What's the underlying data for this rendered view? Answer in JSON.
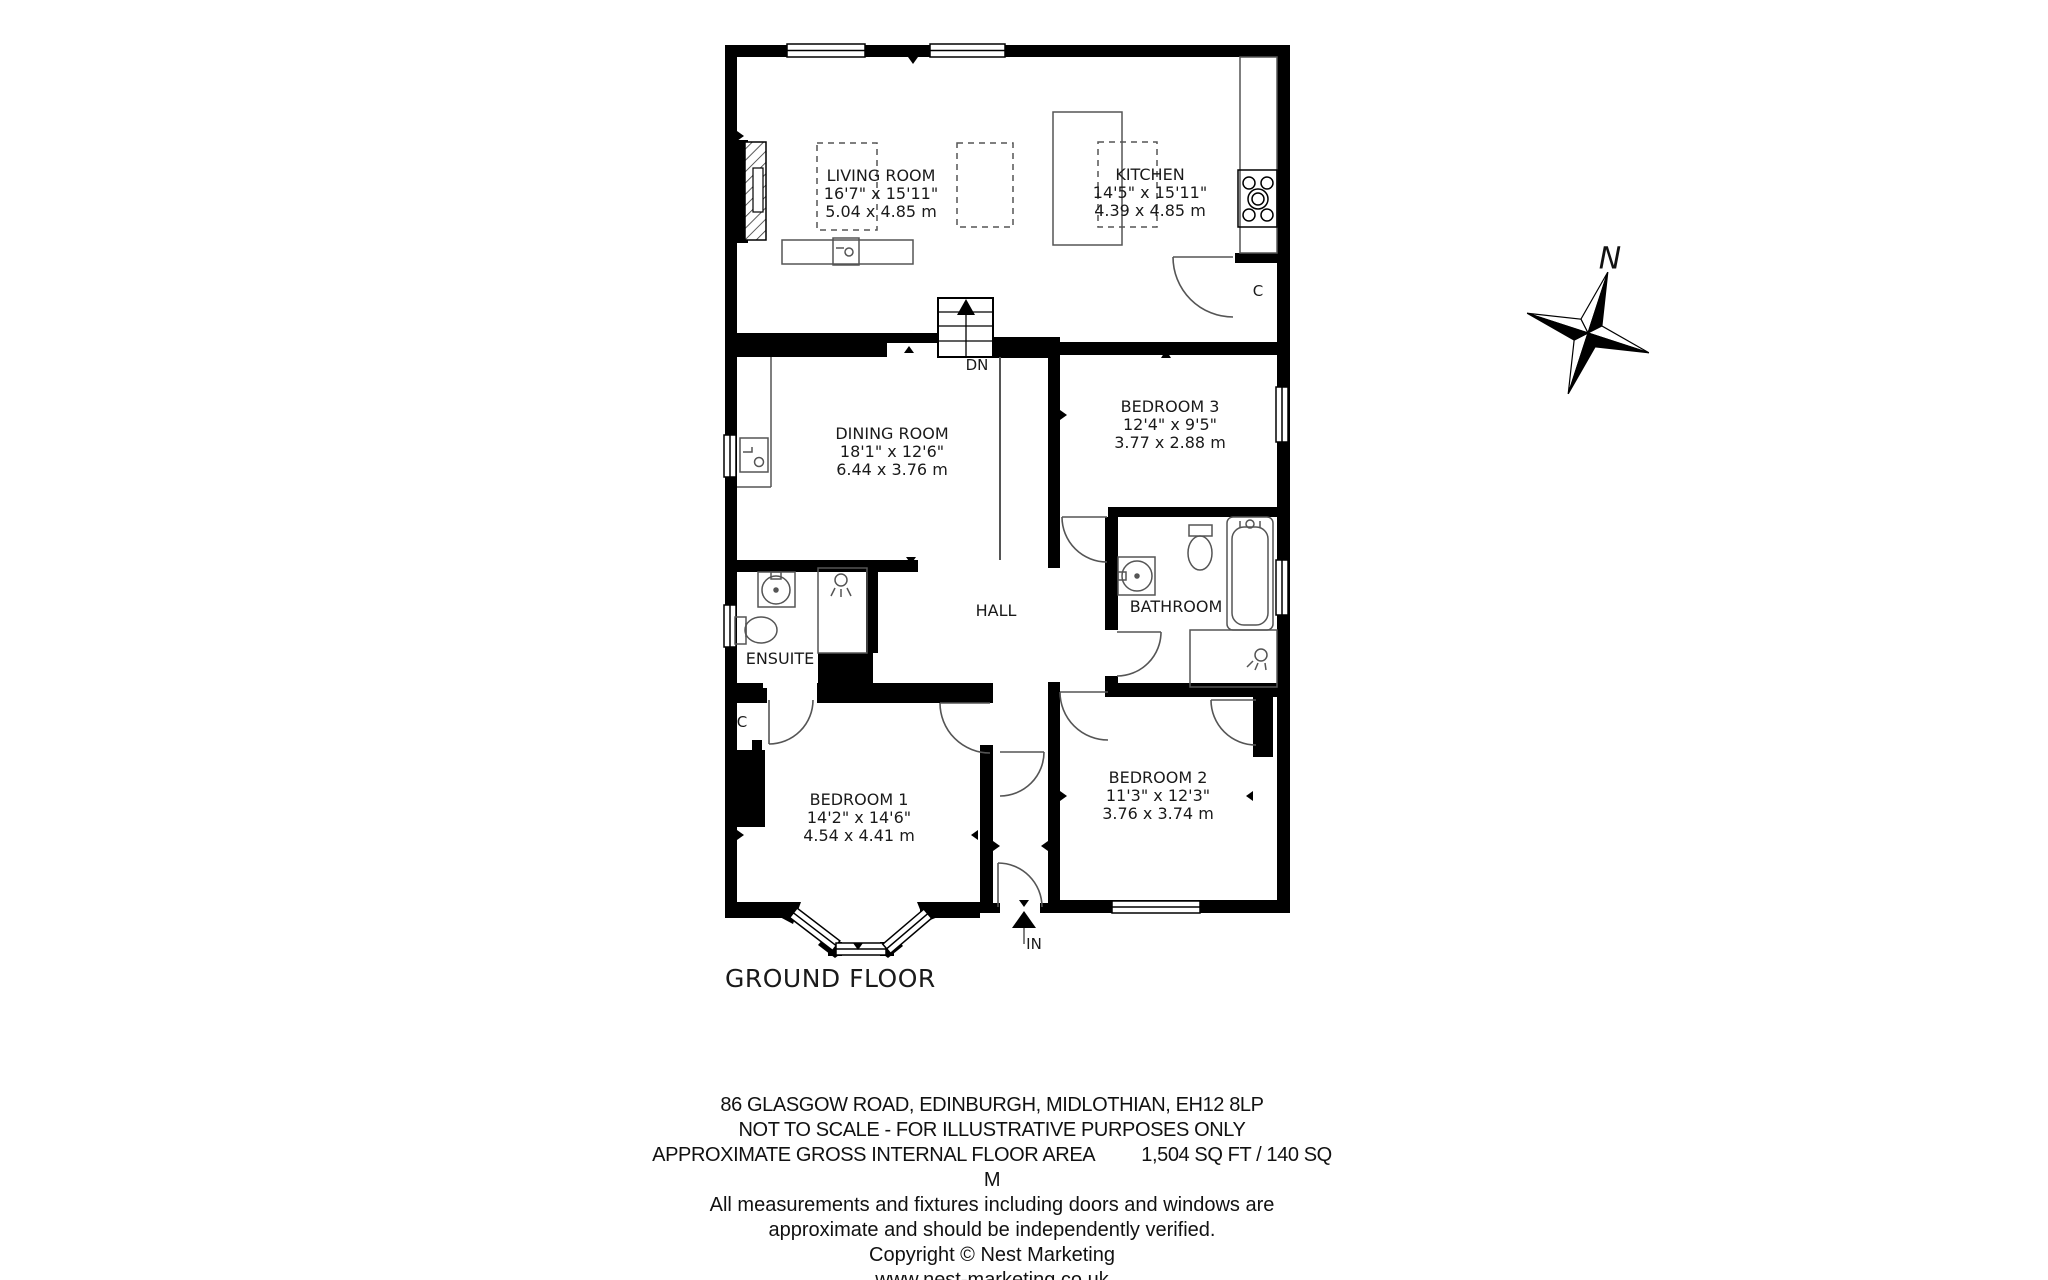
{
  "floorplan": {
    "title": "GROUND FLOOR",
    "compass_label": "N",
    "stairs_label": "DN",
    "entrance_label": "IN",
    "cupboard_label": "C",
    "rooms": {
      "living_room": {
        "name": "LIVING ROOM",
        "imperial": "16'7\" x 15'11\"",
        "metric": "5.04 x 4.85 m"
      },
      "kitchen": {
        "name": "KITCHEN",
        "imperial": "14'5\" x 15'11\"",
        "metric": "4.39 x 4.85 m"
      },
      "dining_room": {
        "name": "DINING ROOM",
        "imperial": "18'1\" x 12'6\"",
        "metric": "6.44 x 3.76 m"
      },
      "bedroom_3": {
        "name": "BEDROOM 3",
        "imperial": "12'4\" x 9'5\"",
        "metric": "3.77 x 2.88 m"
      },
      "bedroom_1": {
        "name": "BEDROOM 1",
        "imperial": "14'2\" x 14'6\"",
        "metric": "4.54 x 4.41 m"
      },
      "bedroom_2": {
        "name": "BEDROOM 2",
        "imperial": "11'3\" x 12'3\"",
        "metric": "3.76 x 3.74 m"
      },
      "bathroom": {
        "name": "BATHROOM"
      },
      "ensuite": {
        "name": "ENSUITE"
      },
      "hall": {
        "name": "HALL"
      }
    }
  },
  "footer": {
    "address": "86 GLASGOW ROAD, EDINBURGH, MIDLOTHIAN, EH12 8LP",
    "scale_note": "NOT TO SCALE - FOR ILLUSTRATIVE PURPOSES ONLY",
    "area_label": "APPROXIMATE GROSS INTERNAL FLOOR AREA",
    "area_value": "1,504 SQ FT /  140 SQ M",
    "measurements_note_1": "All measurements and fixtures including doors and windows are",
    "measurements_note_2": "approximate and should be independently verified.",
    "copyright": "Copyright © Nest Marketing",
    "website": "www.nest-marketing.co.uk"
  }
}
